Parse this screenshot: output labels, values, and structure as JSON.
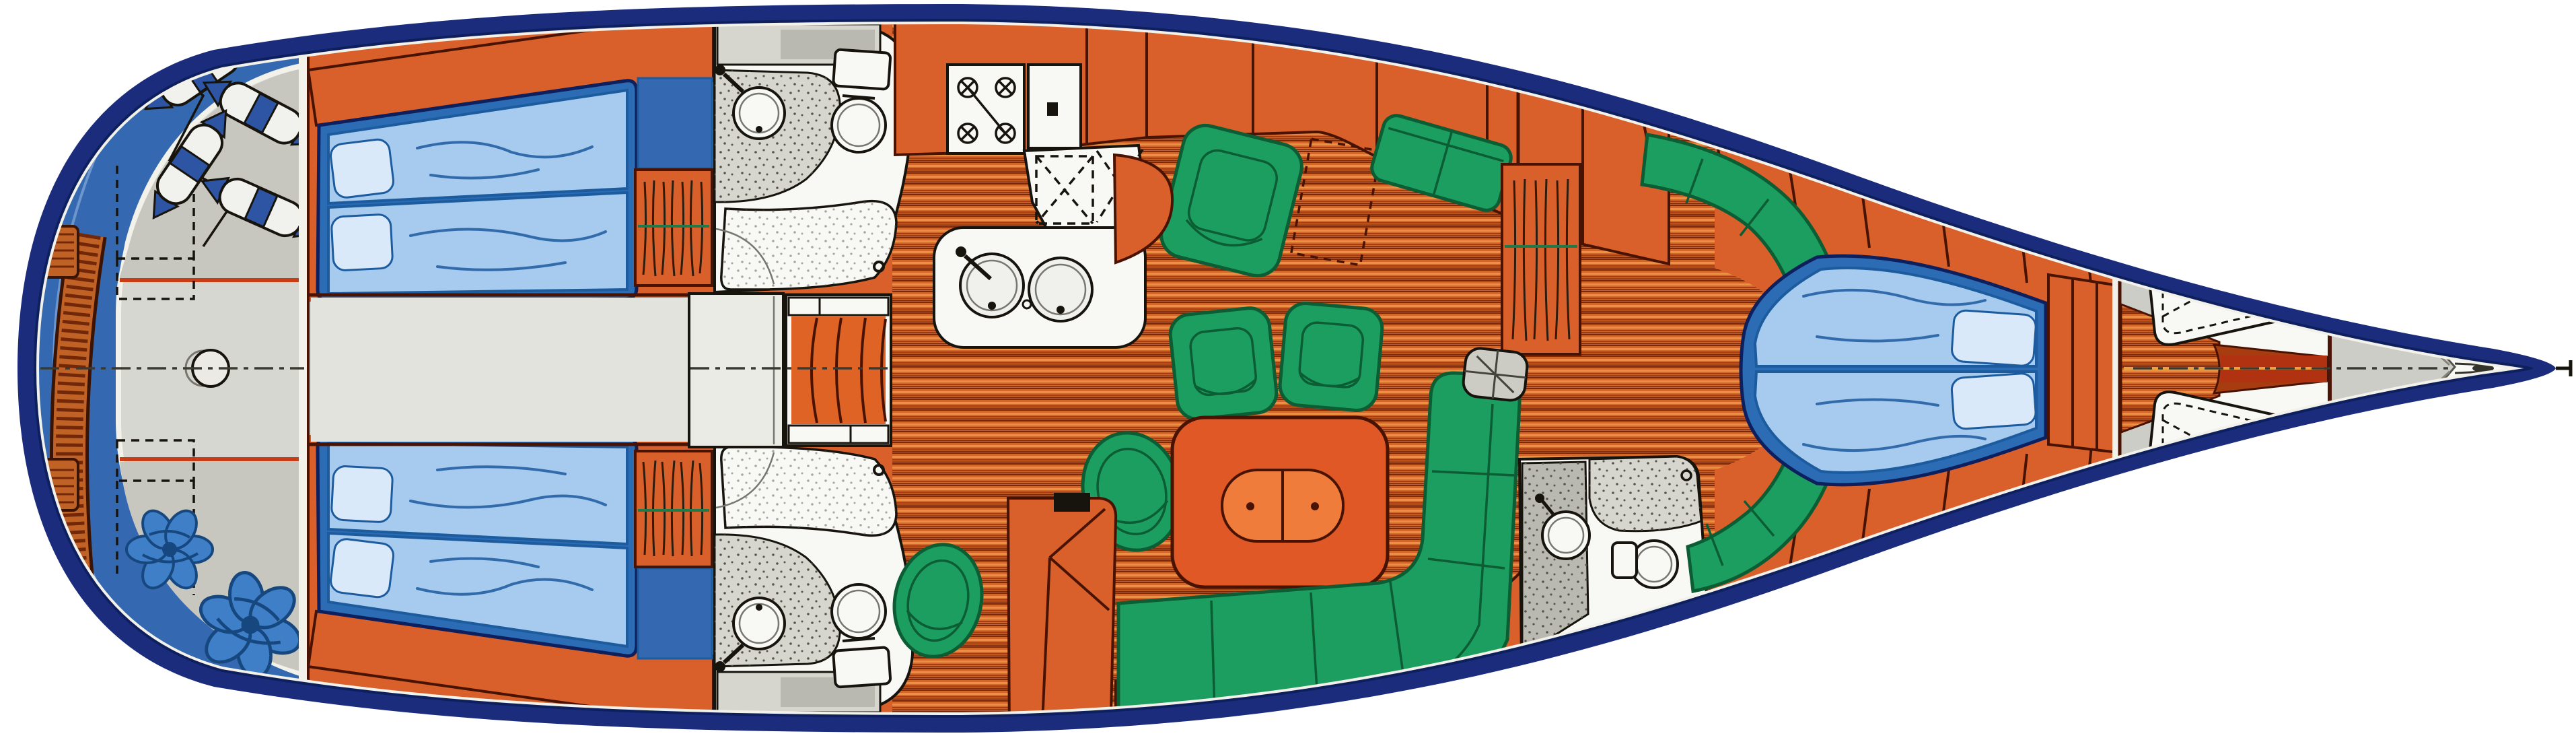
{
  "page": {
    "background": "#ffffff"
  },
  "diagram": {
    "kind": "sailing-yacht-interior-floor-plan",
    "view": "top-down",
    "orientation": {
      "bow": "right",
      "stern": "left"
    },
    "colors": {
      "hullNavy": "#1b2c7d",
      "hullInnerLine": "#0e1f5e",
      "rimWhite": "#f2f1ea",
      "baseWhite": "#f4f3ee",
      "deckBlue": "#3468b0",
      "deckStepLine": "#85a9d8",
      "cockpitGray": "#d7d7d1",
      "benchGray": "#c7c7c0",
      "corridorGray": "#e3e3dd",
      "engineBox": "#ebebe6",
      "redTrim": "#c83c16",
      "gratingWood": "#c06226",
      "gratingSlat": "#712708",
      "gratingEdge": "#3c1404",
      "cabinWood": "#d9602b",
      "woodOutline": "#491303",
      "berthFrame": "#2b6cb4",
      "mattress": "#a6cbee",
      "mattressLine": "#1d5b9f",
      "pillow": "#d9e9fa",
      "teakBase": "#d2662b",
      "teakDark": "#7c2706",
      "teakLight": "#e89340",
      "teakMid": "#a63c10",
      "green": "#1b9e5f",
      "greenDeep": "#0c5c34",
      "tableOrange": "#e05826",
      "tableLeaf": "#ef7c3a",
      "stepsOrange": "#e06326",
      "fixWhite": "#f8f8f5",
      "counterGray": "#d6d6cf",
      "speckDot": "#55554c",
      "ink": "#17130d",
      "fenderBlue": "#2d55a4",
      "fenderWhite": "#f1f1ee",
      "ropeBlue": "#3e7fc7",
      "ropeBlueDeep": "#16477f",
      "bowGray": "#cdcdc7",
      "bowGrayDeep": "#b9b9b1",
      "centerInk": "#3a3a33",
      "mastGray": "#ccccc5"
    },
    "inventory": {
      "stern_cockpit": [
        "swim-platform-grating",
        "side-grate x2",
        "transom-step-arcs",
        "lazarette-dashed-lid x2",
        "steering-post",
        "fender x4",
        "fender-rope",
        "rope-coil-rosette x2",
        "cockpit-bench x2",
        "red-trim-line x2"
      ],
      "aft-cabin-port": [
        "double-berth",
        "mattress x2",
        "pillow x2",
        "blue-locker",
        "wardrobe-with-hangers"
      ],
      "aft-cabin-starboard": [
        "double-berth",
        "mattress x2",
        "pillow x2",
        "blue-locker",
        "wardrobe-with-hangers"
      ],
      "aft-head-port": [
        "hatch-strip",
        "vanity-counter",
        "sink",
        "faucet",
        "toilet",
        "shower-tray",
        "drain",
        "door-swing"
      ],
      "aft-head-starboard": [
        "hatch-strip",
        "vanity-counter",
        "sink",
        "faucet",
        "toilet",
        "shower-tray",
        "drain",
        "door-swing"
      ],
      "companionway": [
        "engine-box",
        "steps x4",
        "step-rail x2"
      ],
      "galley": [
        "stove",
        "burner x4",
        "side-counter",
        "icebox-dashed-lids",
        "double-sink",
        "faucet"
      ],
      "salon": [
        "teak-sole",
        "dining-table",
        "folding-leaf",
        "leaf-hinge x2",
        "armchair-square x3",
        "armchair-oval x2",
        "side-bench",
        "l-settee",
        "settee-cushion-seams",
        "sideboard-dashed-locker",
        "orange-seat-unit",
        "mast-step"
      ],
      "port-wardrobe-forward": [
        "hanging-locker",
        "hanger x7",
        "rod"
      ],
      "forward-head": [
        "speckled-floor",
        "sink",
        "faucet",
        "toilet",
        "counter",
        "shower-area",
        "door-leaf"
      ],
      "forward-cabin": [
        "v-berth",
        "mattress x2",
        "pillow x2",
        "wraparound-settee x2",
        "headboard-lockers",
        "hull-side-lockers"
      ],
      "forepeak": [
        "sail-locker-lid x2",
        "deck-cleat x4",
        "lashing-dashed-lines",
        "anchor-channel",
        "chain-locker-bulkhead",
        "bow-roller",
        "stem-fitting"
      ]
    }
  }
}
